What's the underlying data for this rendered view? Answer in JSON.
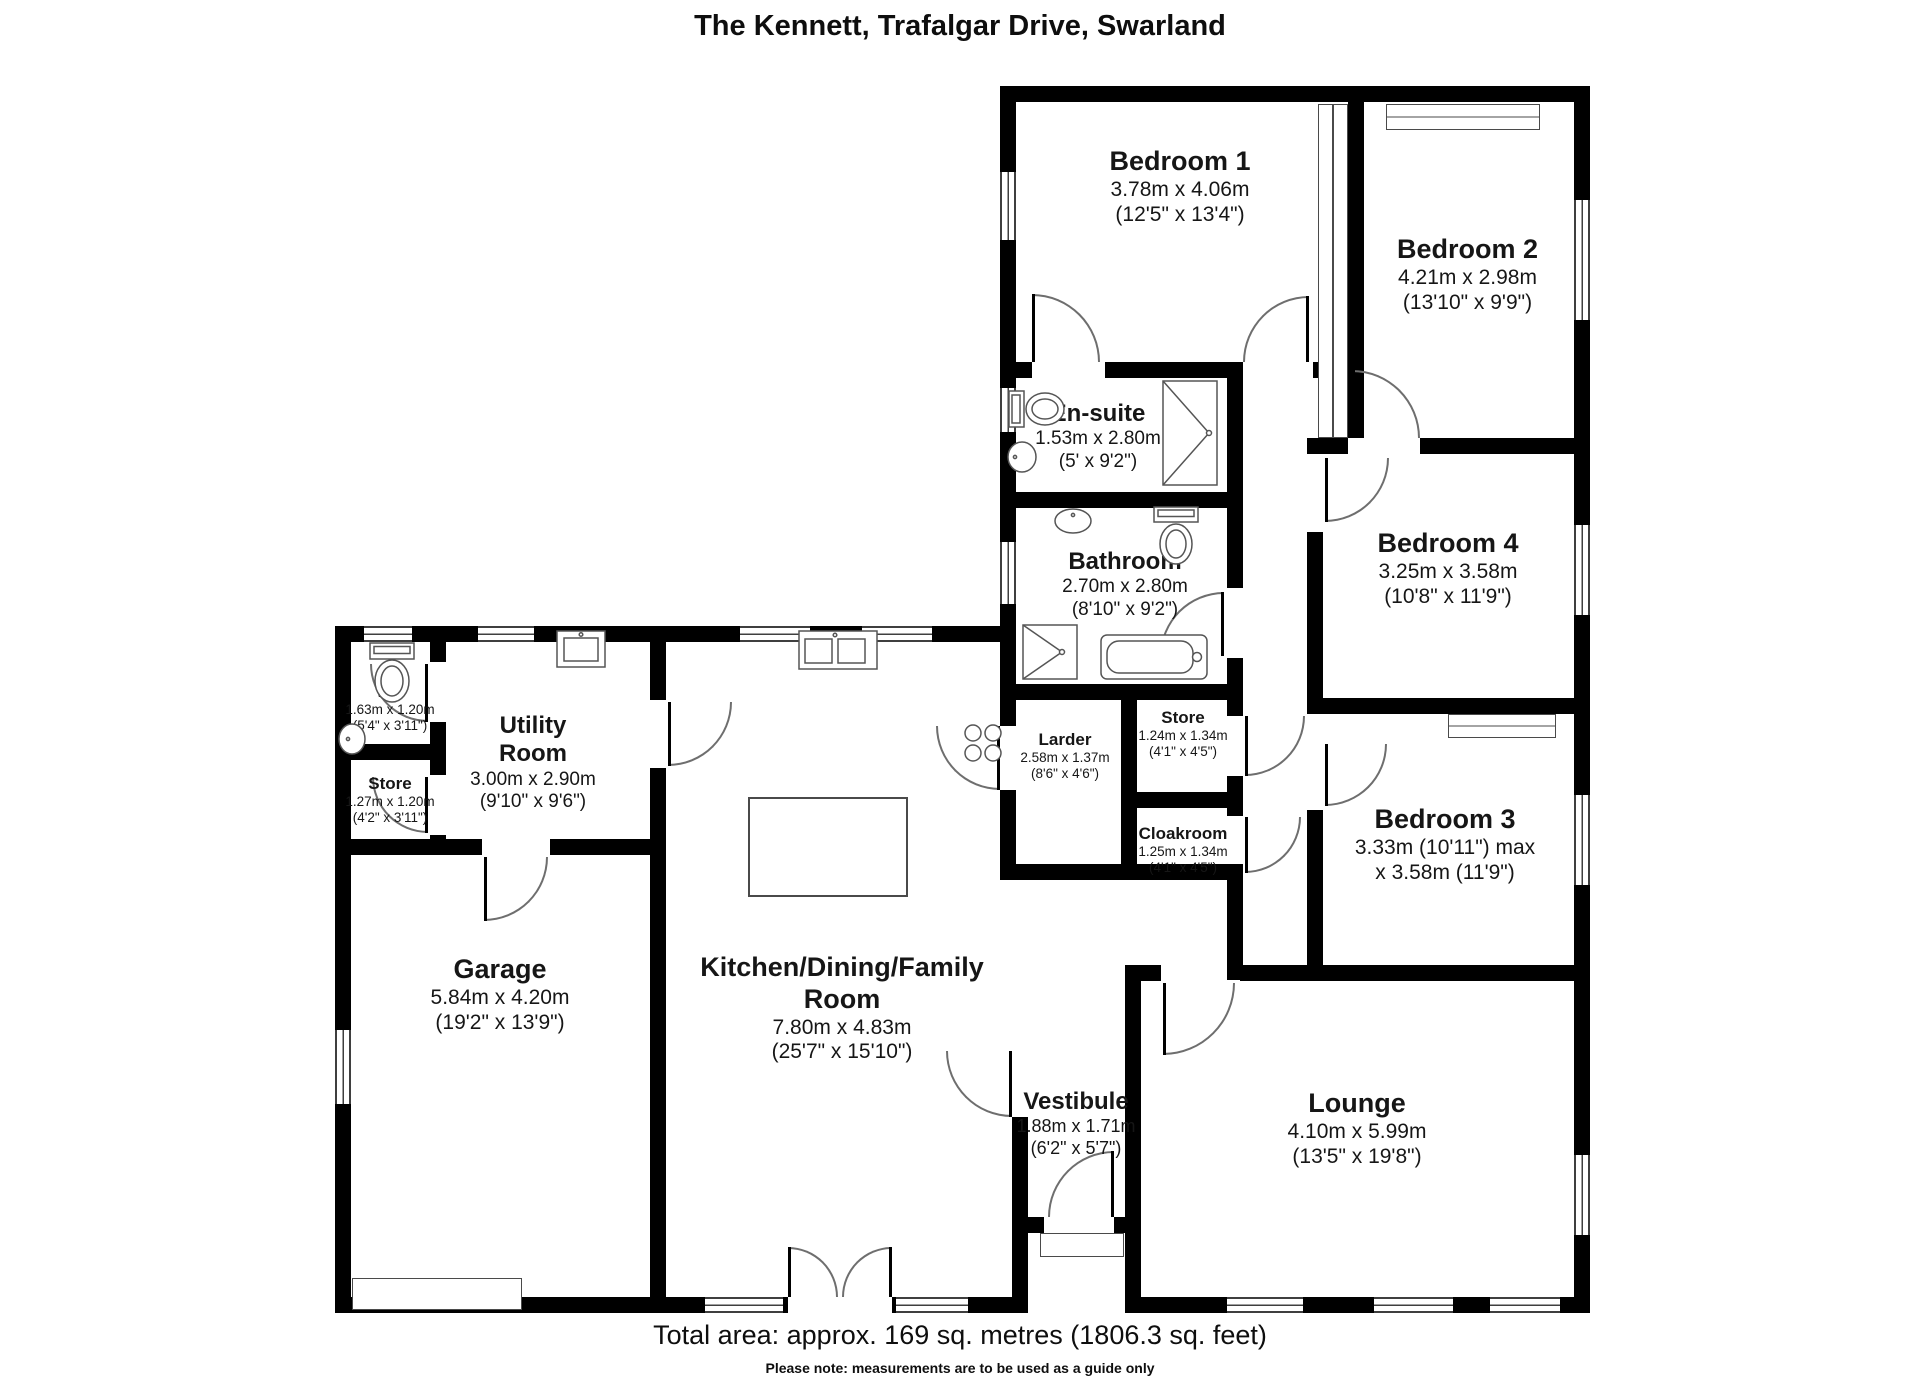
{
  "header": {
    "title": "The Kennett, Trafalgar Drive, Swarland"
  },
  "footer": {
    "total_area": "Total area: approx. 169 sq. metres (1806.3 sq. feet)",
    "note": "Please note: measurements are to be used as a guide only"
  },
  "rooms": [
    {
      "name": "Bedroom 1",
      "dims": "3.78m x 4.06m",
      "imp": "(12'5\" x 13'4\")"
    },
    {
      "name": "Bedroom 2",
      "dims": "4.21m x 2.98m",
      "imp": "(13'10\" x 9'9\")"
    },
    {
      "name": "En-suite",
      "dims": "1.53m x 2.80m",
      "imp": "(5' x 9'2\")"
    },
    {
      "name": "Bathroom",
      "dims": "2.70m x 2.80m",
      "imp": "(8'10\" x 9'2\")"
    },
    {
      "name": "Bedroom 4",
      "dims": "3.25m x 3.58m",
      "imp": "(10'8\" x 11'9\")"
    },
    {
      "name": "Bedroom 3",
      "dims": "3.33m (10'11\") max",
      "imp": "x 3.58m (11'9\")"
    },
    {
      "name": "WC",
      "dims": "1.63m x 1.20m",
      "imp": "(5'4\" x 3'11\")"
    },
    {
      "name": "Store",
      "dims": "1.27m x 1.20m",
      "imp": "(4'2\" x 3'11\")"
    },
    {
      "name": "Utility Room",
      "dims": "3.00m x 2.90m",
      "imp": "(9'10\" x 9'6\")"
    },
    {
      "name": "Larder",
      "dims": "2.58m x 1.37m",
      "imp": "(8'6\" x 4'6\")"
    },
    {
      "name": "Store",
      "dims": "1.24m x 1.34m",
      "imp": "(4'1\" x 4'5\")"
    },
    {
      "name": "Cloakroom",
      "dims": "1.25m x 1.34m",
      "imp": "(4'1\" x 4'5\")"
    },
    {
      "name": "Garage",
      "dims": "5.84m x 4.20m",
      "imp": "(19'2\" x 13'9\")"
    },
    {
      "name": "Kitchen/Dining/Family Room",
      "dims": "7.80m x 4.83m",
      "imp": "(25'7\" x 15'10\")"
    },
    {
      "name": "Vestibule",
      "dims": "1.88m x 1.71m",
      "imp": "(6'2\" x 5'7\")"
    },
    {
      "name": "Lounge",
      "dims": "4.10m x 5.99m",
      "imp": "(13'5\" x 19'8\")"
    }
  ]
}
